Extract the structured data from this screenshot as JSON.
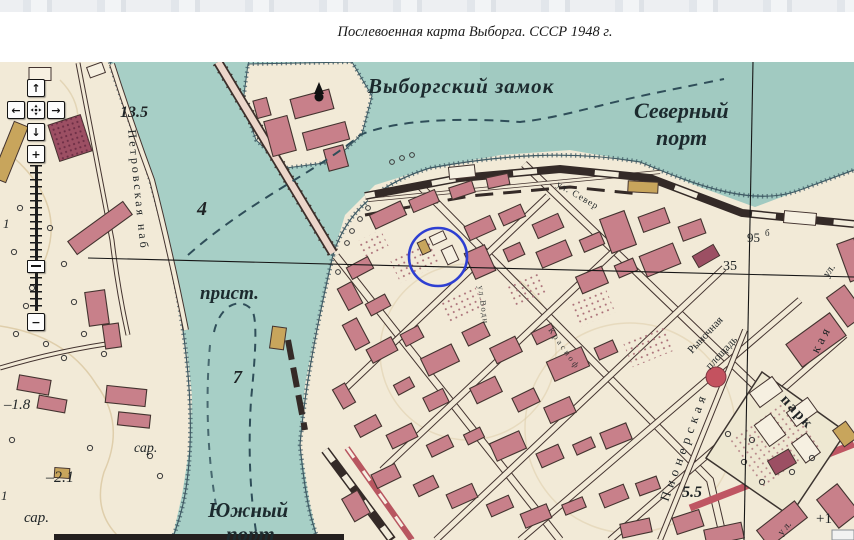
{
  "caption": "Послевоенная карта Выборга. СССР 1948 г.",
  "controls": {
    "pan_up": "↑",
    "pan_down": "↓",
    "pan_left": "←",
    "pan_right": "→",
    "zoom_in": "+",
    "zoom_out": "−"
  },
  "map": {
    "water_labels": {
      "castle": "Выборгский замок",
      "north_port_line1": "Северный",
      "north_port_line2": "порт",
      "south_port_line1": "Южный",
      "south_port_line2": "порт",
      "pier": "прист."
    },
    "depths": {
      "d1": "13.5",
      "d2": "4",
      "d3": "7"
    },
    "heights": {
      "h35": "35",
      "h95": "95",
      "h95_sup": "б",
      "h55": "5.5",
      "plus1": "+1",
      "m18": "–1.8",
      "m21": "–2.1"
    },
    "land_labels": {
      "embankment": "Петровская наб",
      "barn1": "сар.",
      "barn2": "сар.",
      "park": "парк",
      "market_line1": "Рыночная",
      "market_line2": "площадь",
      "pioneer_street": "Пионерская",
      "street_frag_ul_bottom": "у л.",
      "north_street": "ул. Север",
      "street_frag_kaya": "кая",
      "street_frag_ul": "ул.",
      "street_frag_krasno": "Красноф",
      "street_frag_vodn": "ул.Водн",
      "edge_frag1": "1",
      "edge_frag2": "1"
    },
    "colors": {
      "water": "#a7cfc6",
      "land": "#f2ead7",
      "building": "#c8808a",
      "quay_dark": "#342a27",
      "annotation_blue": "#2e3fd2",
      "road_red": "#c4525f"
    }
  }
}
